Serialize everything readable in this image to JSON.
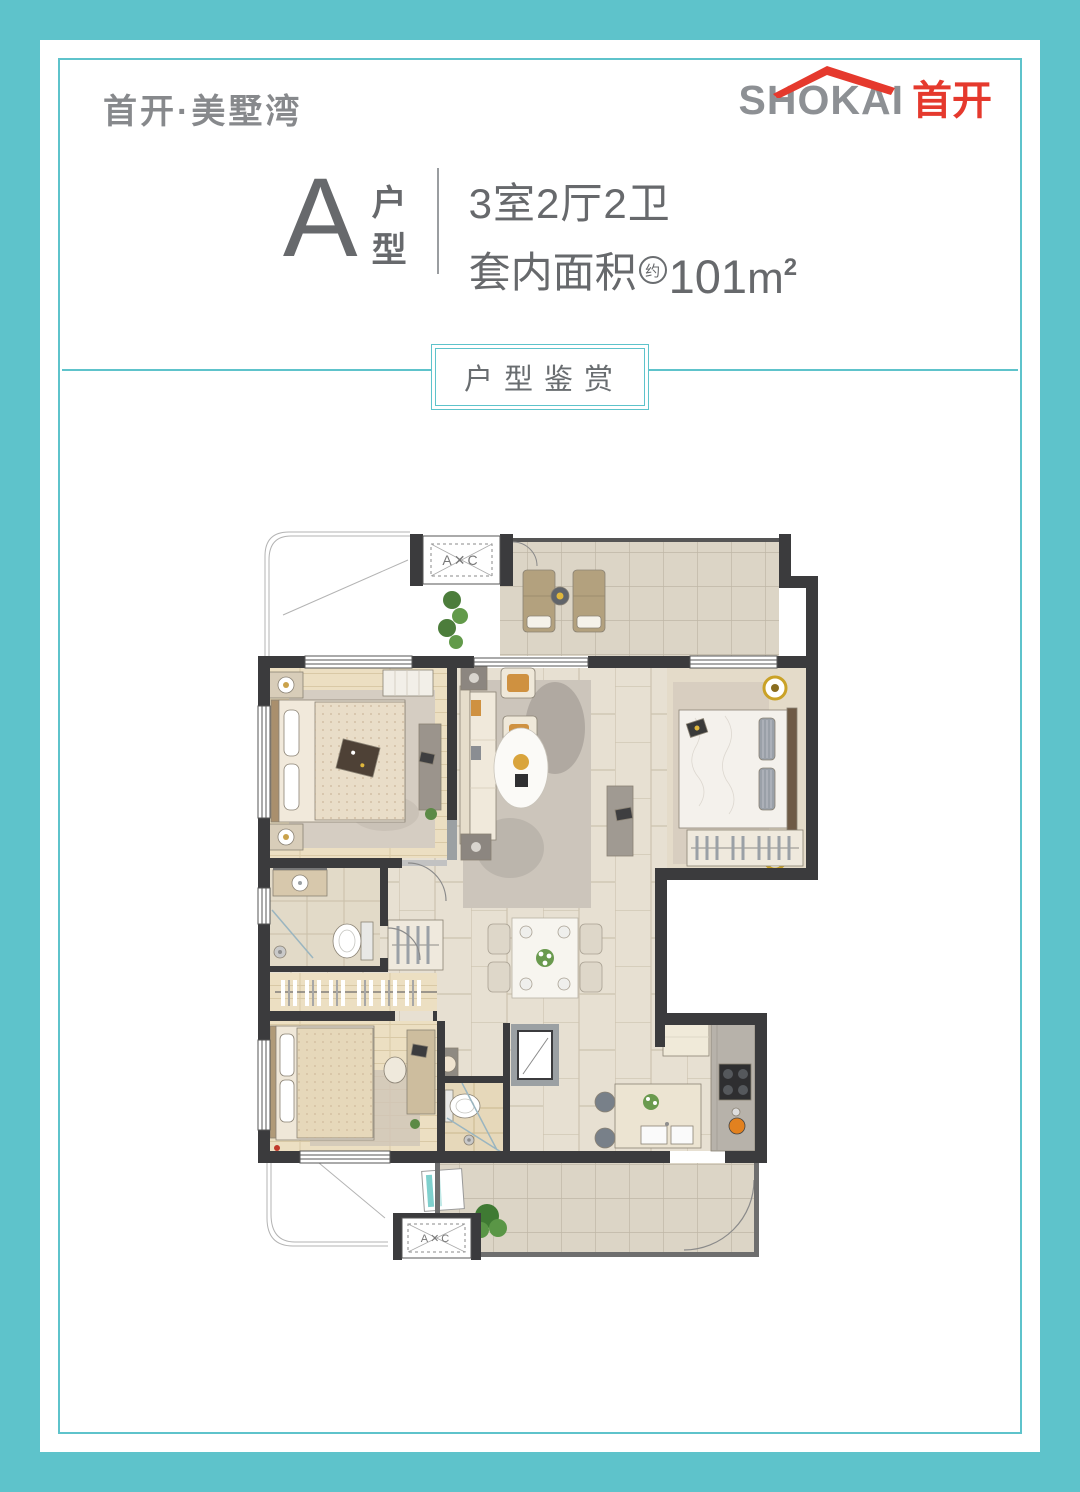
{
  "page": {
    "frame_color": "#5ec3cb",
    "background": "#ffffff"
  },
  "header": {
    "brand_script": "首开·美墅湾",
    "corp": {
      "latin": "SHOKAI",
      "cn": "首开",
      "roof_color": "#e5392d",
      "latin_color": "#8d9094",
      "cn_color": "#e5392d"
    }
  },
  "unit": {
    "letter": "A",
    "type_char_top": "户",
    "type_char_bottom": "型",
    "spec_line": "3室2厅2卫",
    "area_prefix": "套内面积",
    "area_approx": "约",
    "area_value": "101",
    "area_unit_base": "m",
    "area_unit_sup": "2"
  },
  "section": {
    "label": "户型鉴赏",
    "line_color": "#5ec3cb",
    "text_color": "#696d70"
  },
  "floor_plan": {
    "ac_box_top_label": "A✕C",
    "ac_box_bottom_label": "A✕C",
    "colors": {
      "wall": "#3b3b3d",
      "wall_gray": "#9ba0a3",
      "floor_tile": "#e7e0d2",
      "balcony_tile": "#dcd5c6",
      "wood": "#ecdfc2",
      "accent_amber": "#cf9140",
      "plant_green": "#4f8040"
    }
  }
}
